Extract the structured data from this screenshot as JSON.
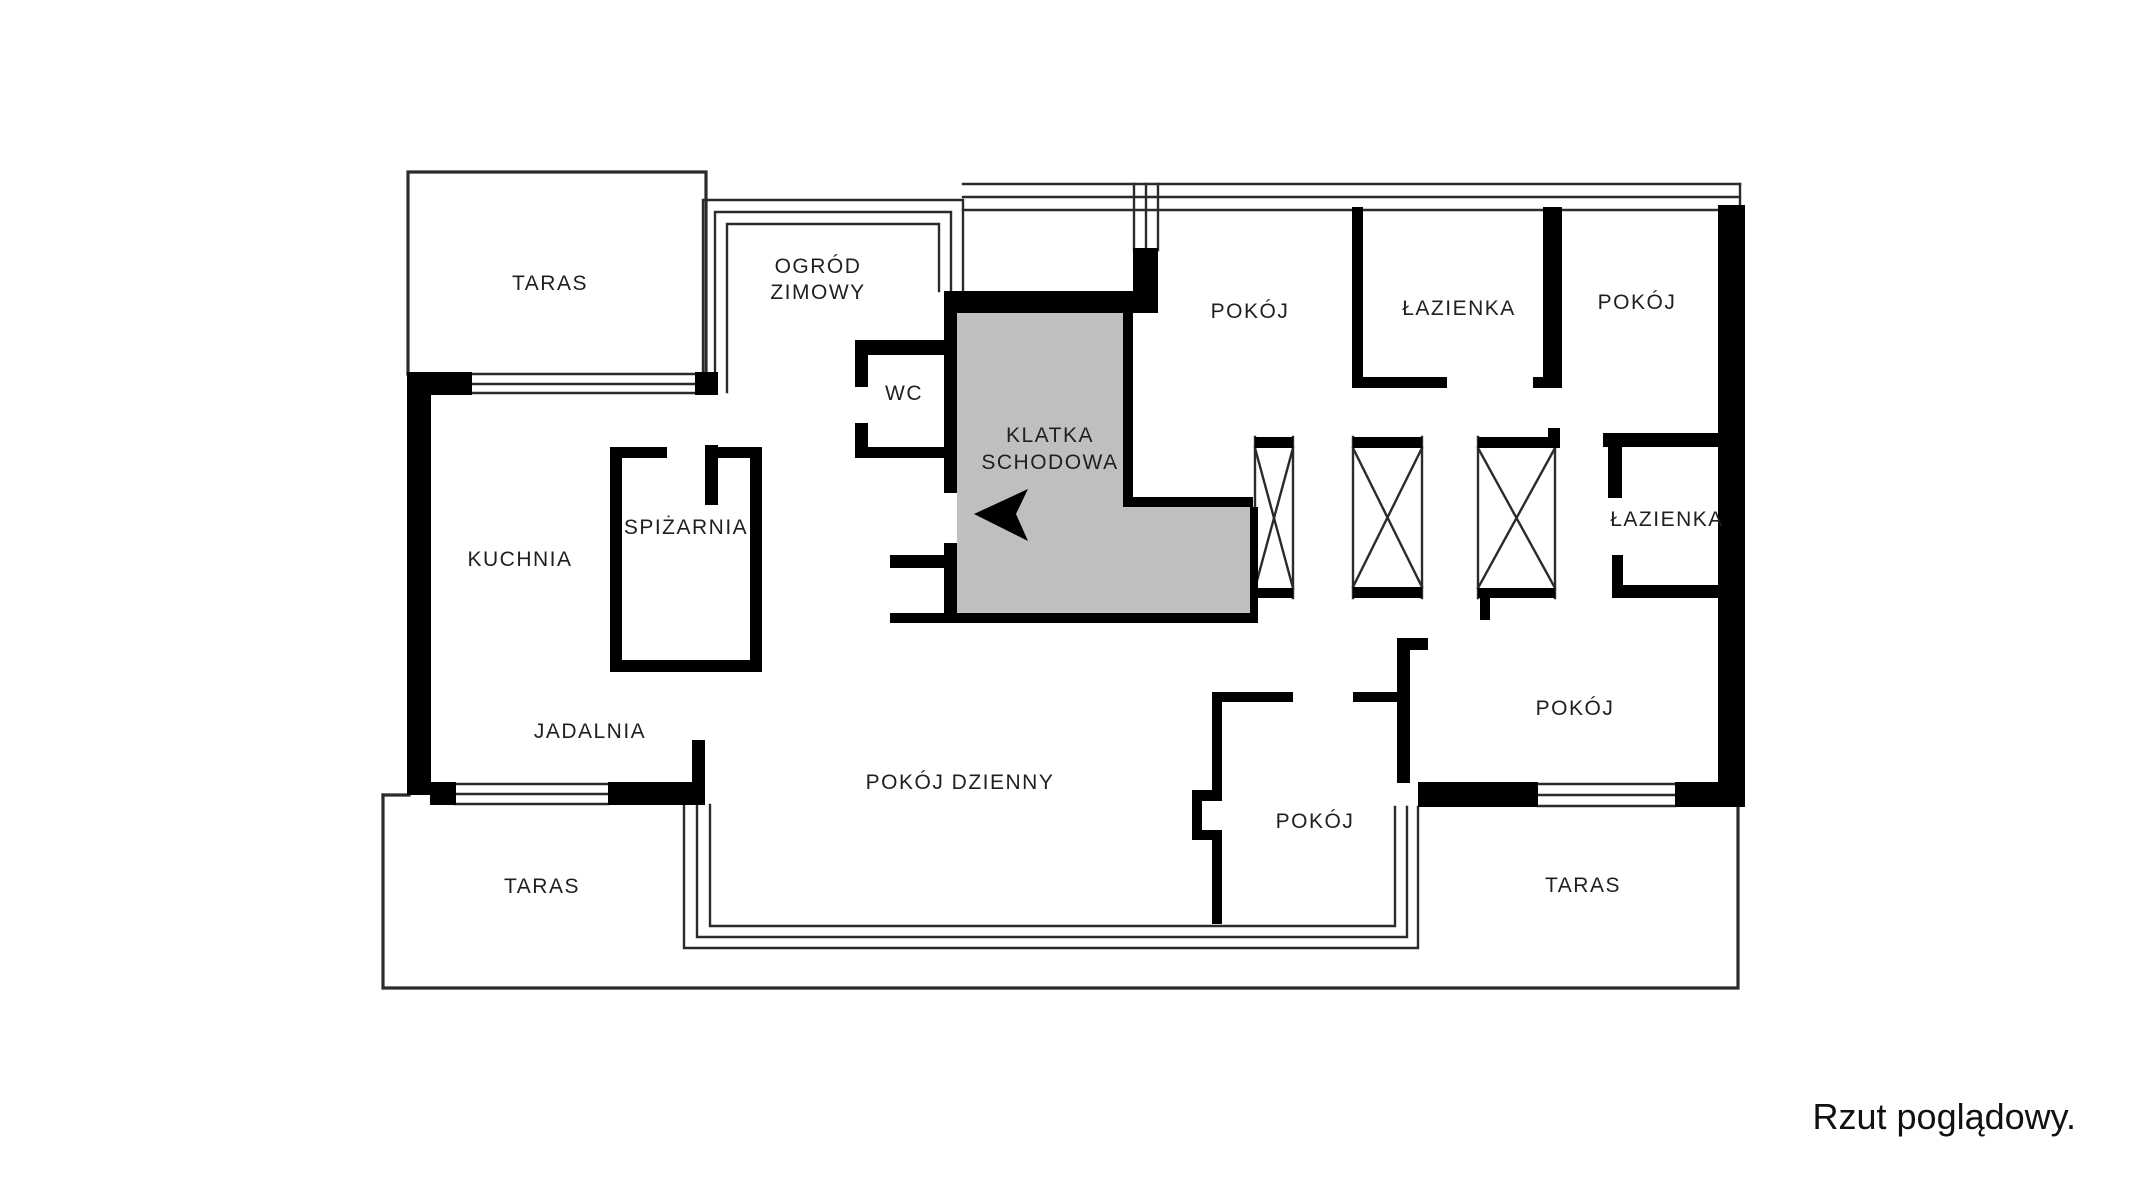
{
  "footer": {
    "note": "Rzut poglądowy."
  },
  "colors": {
    "background": "#ffffff",
    "wall": "#000000",
    "stair_fill": "#bfbfbf",
    "thin_line": "#2b2b2b",
    "label_text": "#1f1f1f"
  },
  "floorplan": {
    "labels": [
      {
        "id": "taras-top-left",
        "lines": [
          "TARAS"
        ],
        "x": 550,
        "y": 290,
        "lh": 26
      },
      {
        "id": "ogrod-zimowy",
        "lines": [
          "OGRÓD",
          "ZIMOWY"
        ],
        "x": 818,
        "y": 273,
        "lh": 26
      },
      {
        "id": "wc",
        "lines": [
          "WC"
        ],
        "x": 904,
        "y": 400,
        "lh": 26
      },
      {
        "id": "klatka-schodowa",
        "lines": [
          "KLATKA",
          "SCHODOWA"
        ],
        "x": 1050,
        "y": 442,
        "lh": 27
      },
      {
        "id": "pokoj-top",
        "lines": [
          "POKÓJ"
        ],
        "x": 1250,
        "y": 318,
        "lh": 26
      },
      {
        "id": "lazienka-top",
        "lines": [
          "ŁAZIENKA"
        ],
        "x": 1459,
        "y": 315,
        "lh": 26
      },
      {
        "id": "pokoj-top-right",
        "lines": [
          "POKÓJ"
        ],
        "x": 1637,
        "y": 309,
        "lh": 26
      },
      {
        "id": "lazienka-right",
        "lines": [
          "ŁAZIENKA"
        ],
        "x": 1667,
        "y": 526,
        "lh": 26
      },
      {
        "id": "spizarnia",
        "lines": [
          "SPIŻARNIA"
        ],
        "x": 686,
        "y": 534,
        "lh": 26
      },
      {
        "id": "kuchnia",
        "lines": [
          "KUCHNIA"
        ],
        "x": 520,
        "y": 566,
        "lh": 26
      },
      {
        "id": "jadalnia",
        "lines": [
          "JADALNIA"
        ],
        "x": 590,
        "y": 738,
        "lh": 26
      },
      {
        "id": "pokoj-dzienny",
        "lines": [
          "POKÓJ DZIENNY"
        ],
        "x": 960,
        "y": 789,
        "lh": 26
      },
      {
        "id": "pokoj-bottom",
        "lines": [
          "POKÓJ"
        ],
        "x": 1315,
        "y": 828,
        "lh": 26
      },
      {
        "id": "pokoj-right",
        "lines": [
          "POKÓJ"
        ],
        "x": 1575,
        "y": 715,
        "lh": 26
      },
      {
        "id": "taras-bottom-left",
        "lines": [
          "TARAS"
        ],
        "x": 542,
        "y": 893,
        "lh": 26
      },
      {
        "id": "taras-bottom-right",
        "lines": [
          "TARAS"
        ],
        "x": 1583,
        "y": 892,
        "lh": 26
      }
    ],
    "label_font_size": 21,
    "stair_polygon": [
      [
        957,
        313
      ],
      [
        1123,
        313
      ],
      [
        1123,
        507
      ],
      [
        1250,
        507
      ],
      [
        1250,
        613
      ],
      [
        957,
        613
      ]
    ],
    "entrance_arrow": [
      [
        974,
        514
      ],
      [
        1028,
        489
      ],
      [
        1016,
        514
      ],
      [
        1028,
        541
      ]
    ],
    "walls": [
      [
        408,
        372,
        64,
        23
      ],
      [
        695,
        372,
        23,
        23
      ],
      [
        407,
        372,
        24,
        423
      ],
      [
        430,
        782,
        26,
        23
      ],
      [
        608,
        782,
        97,
        23
      ],
      [
        692,
        740,
        13,
        45
      ],
      [
        944,
        291,
        214,
        22
      ],
      [
        1133,
        248,
        25,
        65
      ],
      [
        944,
        313,
        13,
        180
      ],
      [
        944,
        543,
        13,
        70
      ],
      [
        855,
        340,
        89,
        15
      ],
      [
        855,
        355,
        13,
        32
      ],
      [
        855,
        423,
        13,
        24
      ],
      [
        855,
        447,
        89,
        11
      ],
      [
        890,
        555,
        67,
        13
      ],
      [
        890,
        613,
        368,
        10
      ],
      [
        1123,
        313,
        10,
        194
      ],
      [
        1123,
        497,
        130,
        10
      ],
      [
        1250,
        507,
        8,
        106
      ],
      [
        1255,
        437,
        38,
        11
      ],
      [
        1255,
        588,
        38,
        10
      ],
      [
        1353,
        437,
        69,
        11
      ],
      [
        1353,
        587,
        69,
        11
      ],
      [
        1478,
        437,
        74,
        11
      ],
      [
        1548,
        428,
        12,
        20
      ],
      [
        1478,
        588,
        77,
        10
      ],
      [
        1480,
        598,
        10,
        22
      ],
      [
        1352,
        207,
        11,
        181
      ],
      [
        1363,
        377,
        84,
        11
      ],
      [
        1533,
        377,
        29,
        11
      ],
      [
        1543,
        207,
        19,
        181
      ],
      [
        1603,
        433,
        115,
        14
      ],
      [
        1608,
        447,
        14,
        51
      ],
      [
        1612,
        555,
        11,
        43
      ],
      [
        1612,
        585,
        106,
        13
      ],
      [
        1718,
        205,
        27,
        602
      ],
      [
        1212,
        692,
        81,
        10
      ],
      [
        1353,
        692,
        44,
        10
      ],
      [
        1212,
        692,
        10,
        108
      ],
      [
        1192,
        790,
        30,
        11
      ],
      [
        1192,
        801,
        10,
        29
      ],
      [
        1192,
        830,
        30,
        10
      ],
      [
        1212,
        840,
        10,
        84
      ],
      [
        1397,
        638,
        13,
        145
      ],
      [
        1397,
        638,
        31,
        12
      ],
      [
        1418,
        782,
        120,
        25
      ],
      [
        1675,
        782,
        70,
        25
      ],
      [
        610,
        447,
        12,
        225
      ],
      [
        750,
        447,
        12,
        225
      ],
      [
        610,
        660,
        152,
        12
      ],
      [
        610,
        447,
        57,
        11
      ],
      [
        717,
        447,
        45,
        11
      ],
      [
        705,
        445,
        13,
        60
      ]
    ],
    "thin_paths": [
      {
        "id": "terrace-top-left-outline",
        "w": 3.2,
        "pts": [
          [
            408,
            374
          ],
          [
            408,
            172
          ],
          [
            706,
            172
          ],
          [
            706,
            374
          ]
        ]
      },
      {
        "id": "terrace-bottom-outline",
        "w": 3.2,
        "pts": [
          [
            383,
            795
          ],
          [
            383,
            988
          ],
          [
            1738,
            988
          ],
          [
            1738,
            806
          ]
        ]
      },
      {
        "id": "terrace-bottom-top-stub",
        "w": 3.2,
        "pts": [
          [
            383,
            795
          ],
          [
            409,
            795
          ]
        ]
      },
      {
        "id": "oz-glass-outer",
        "pts": [
          [
            703,
            392
          ],
          [
            703,
            200
          ],
          [
            963,
            200
          ],
          [
            963,
            291
          ]
        ]
      },
      {
        "id": "oz-glass-mid",
        "pts": [
          [
            715,
            392
          ],
          [
            715,
            212
          ],
          [
            951,
            212
          ],
          [
            951,
            291
          ]
        ]
      },
      {
        "id": "oz-glass-inner",
        "pts": [
          [
            727,
            392
          ],
          [
            727,
            224
          ],
          [
            939,
            224
          ],
          [
            939,
            291
          ]
        ]
      },
      {
        "id": "north-glass-1",
        "pts": [
          [
            963,
            184
          ],
          [
            1740,
            184
          ]
        ]
      },
      {
        "id": "north-glass-2",
        "pts": [
          [
            963,
            197
          ],
          [
            1740,
            197
          ]
        ]
      },
      {
        "id": "north-glass-3",
        "pts": [
          [
            963,
            210
          ],
          [
            1740,
            210
          ]
        ]
      },
      {
        "id": "north-glass-right-end",
        "pts": [
          [
            1740,
            184
          ],
          [
            1740,
            207
          ]
        ]
      },
      {
        "id": "porch-glass-1",
        "pts": [
          [
            1134,
            184
          ],
          [
            1134,
            250
          ]
        ]
      },
      {
        "id": "porch-glass-2",
        "pts": [
          [
            1146,
            184
          ],
          [
            1146,
            250
          ]
        ]
      },
      {
        "id": "porch-glass-3",
        "pts": [
          [
            1158,
            184
          ],
          [
            1158,
            250
          ]
        ]
      },
      {
        "id": "window-taras-1",
        "pts": [
          [
            472,
            374
          ],
          [
            695,
            374
          ]
        ]
      },
      {
        "id": "window-taras-2",
        "pts": [
          [
            472,
            384
          ],
          [
            695,
            384
          ]
        ]
      },
      {
        "id": "window-taras-3",
        "pts": [
          [
            472,
            393
          ],
          [
            695,
            393
          ]
        ]
      },
      {
        "id": "window-jadalnia-1",
        "pts": [
          [
            455,
            784
          ],
          [
            608,
            784
          ]
        ]
      },
      {
        "id": "window-jadalnia-2",
        "pts": [
          [
            455,
            794
          ],
          [
            608,
            794
          ]
        ]
      },
      {
        "id": "window-jadalnia-3",
        "pts": [
          [
            455,
            804
          ],
          [
            608,
            804
          ]
        ]
      },
      {
        "id": "window-pokoj-right-1",
        "pts": [
          [
            1538,
            784
          ],
          [
            1675,
            784
          ]
        ]
      },
      {
        "id": "window-pokoj-right-2",
        "pts": [
          [
            1538,
            795
          ],
          [
            1675,
            795
          ]
        ]
      },
      {
        "id": "window-pokoj-right-3",
        "pts": [
          [
            1538,
            806
          ],
          [
            1675,
            806
          ]
        ]
      },
      {
        "id": "bay-glass-outer",
        "pts": [
          [
            684,
            805
          ],
          [
            684,
            948
          ],
          [
            1418,
            948
          ],
          [
            1418,
            807
          ]
        ]
      },
      {
        "id": "bay-glass-mid",
        "pts": [
          [
            697,
            805
          ],
          [
            697,
            937
          ],
          [
            1407,
            937
          ],
          [
            1407,
            807
          ]
        ]
      },
      {
        "id": "bay-glass-inner",
        "pts": [
          [
            710,
            805
          ],
          [
            710,
            926
          ],
          [
            1395,
            926
          ],
          [
            1395,
            807
          ]
        ]
      },
      {
        "id": "shaft-1-side-left",
        "pts": [
          [
            1255,
            437
          ],
          [
            1255,
            598
          ]
        ]
      },
      {
        "id": "shaft-1-side-right",
        "pts": [
          [
            1293,
            437
          ],
          [
            1293,
            598
          ]
        ]
      },
      {
        "id": "shaft-1-cross-a",
        "pts": [
          [
            1255,
            448
          ],
          [
            1293,
            588
          ]
        ]
      },
      {
        "id": "shaft-1-cross-b",
        "pts": [
          [
            1293,
            448
          ],
          [
            1255,
            588
          ]
        ]
      },
      {
        "id": "shaft-2-side-left",
        "pts": [
          [
            1353,
            437
          ],
          [
            1353,
            598
          ]
        ]
      },
      {
        "id": "shaft-2-side-right",
        "pts": [
          [
            1422,
            437
          ],
          [
            1422,
            598
          ]
        ]
      },
      {
        "id": "shaft-2-cross-a",
        "pts": [
          [
            1353,
            448
          ],
          [
            1422,
            587
          ]
        ]
      },
      {
        "id": "shaft-2-cross-b",
        "pts": [
          [
            1422,
            448
          ],
          [
            1353,
            587
          ]
        ]
      },
      {
        "id": "shaft-3-side-left",
        "pts": [
          [
            1478,
            437
          ],
          [
            1478,
            598
          ]
        ]
      },
      {
        "id": "shaft-3-side-right",
        "pts": [
          [
            1555,
            437
          ],
          [
            1555,
            598
          ]
        ]
      },
      {
        "id": "shaft-3-cross-a",
        "pts": [
          [
            1478,
            448
          ],
          [
            1555,
            588
          ]
        ]
      },
      {
        "id": "shaft-3-cross-b",
        "pts": [
          [
            1555,
            448
          ],
          [
            1478,
            588
          ]
        ]
      }
    ]
  }
}
